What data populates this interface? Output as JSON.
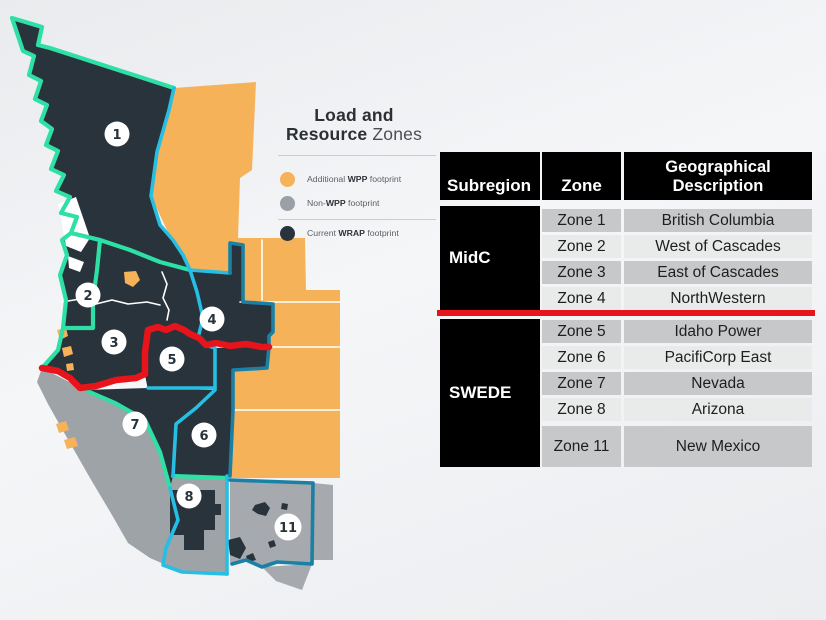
{
  "title": {
    "line1": "Load and",
    "line2_bold": "Resource",
    "line2_light": "Zones"
  },
  "legend": {
    "items": [
      {
        "icon": "orange-dot",
        "swatch_color": "#f6b258",
        "pre": "Additional ",
        "bold": "WPP",
        "post": " footprint"
      },
      {
        "icon": "gray-dot",
        "swatch_color": "#9aa0a6",
        "pre": "Non-",
        "bold": "WPP",
        "post": " footprint"
      },
      {
        "icon": "dark-dot",
        "swatch_color": "#28333b",
        "pre": "Current ",
        "bold": "WRAP",
        "post": " footprint"
      }
    ]
  },
  "map": {
    "zone_markers": [
      {
        "label": "1"
      },
      {
        "label": "2"
      },
      {
        "label": "3"
      },
      {
        "label": "4"
      },
      {
        "label": "5"
      },
      {
        "label": "6"
      },
      {
        "label": "7"
      },
      {
        "label": "8"
      },
      {
        "label": "11"
      }
    ],
    "region_colors": {
      "current_wrap_footprint": "#28333b",
      "additional_wpp_footprint": "#f6b258",
      "non_wpp_footprint": "#9ea3a8",
      "outer_boundary_teal": "#2ee0a5",
      "inner_boundary_cyan": "#26bfe3",
      "east_boundary_blue": "#1a80a5",
      "midc_swede_divider_red": "#e8141c"
    }
  },
  "table": {
    "headers": [
      "Subregion",
      "Zone",
      "Geographical Description"
    ],
    "groups": [
      {
        "subregion": "MidC",
        "rows": [
          {
            "zone": "Zone 1",
            "desc": "British Columbia"
          },
          {
            "zone": "Zone 2",
            "desc": "West of Cascades"
          },
          {
            "zone": "Zone 3",
            "desc": "East of Cascades"
          },
          {
            "zone": "Zone 4",
            "desc": "NorthWestern"
          }
        ]
      },
      {
        "subregion": "SWEDE",
        "rows": [
          {
            "zone": "Zone 5",
            "desc": "Idaho Power"
          },
          {
            "zone": "Zone 6",
            "desc": "PacifiCorp East"
          },
          {
            "zone": "Zone 7",
            "desc": "Nevada"
          },
          {
            "zone": "Zone 8",
            "desc": "Arizona"
          },
          {
            "zone": "Zone 11",
            "desc": "New Mexico"
          }
        ]
      }
    ]
  }
}
